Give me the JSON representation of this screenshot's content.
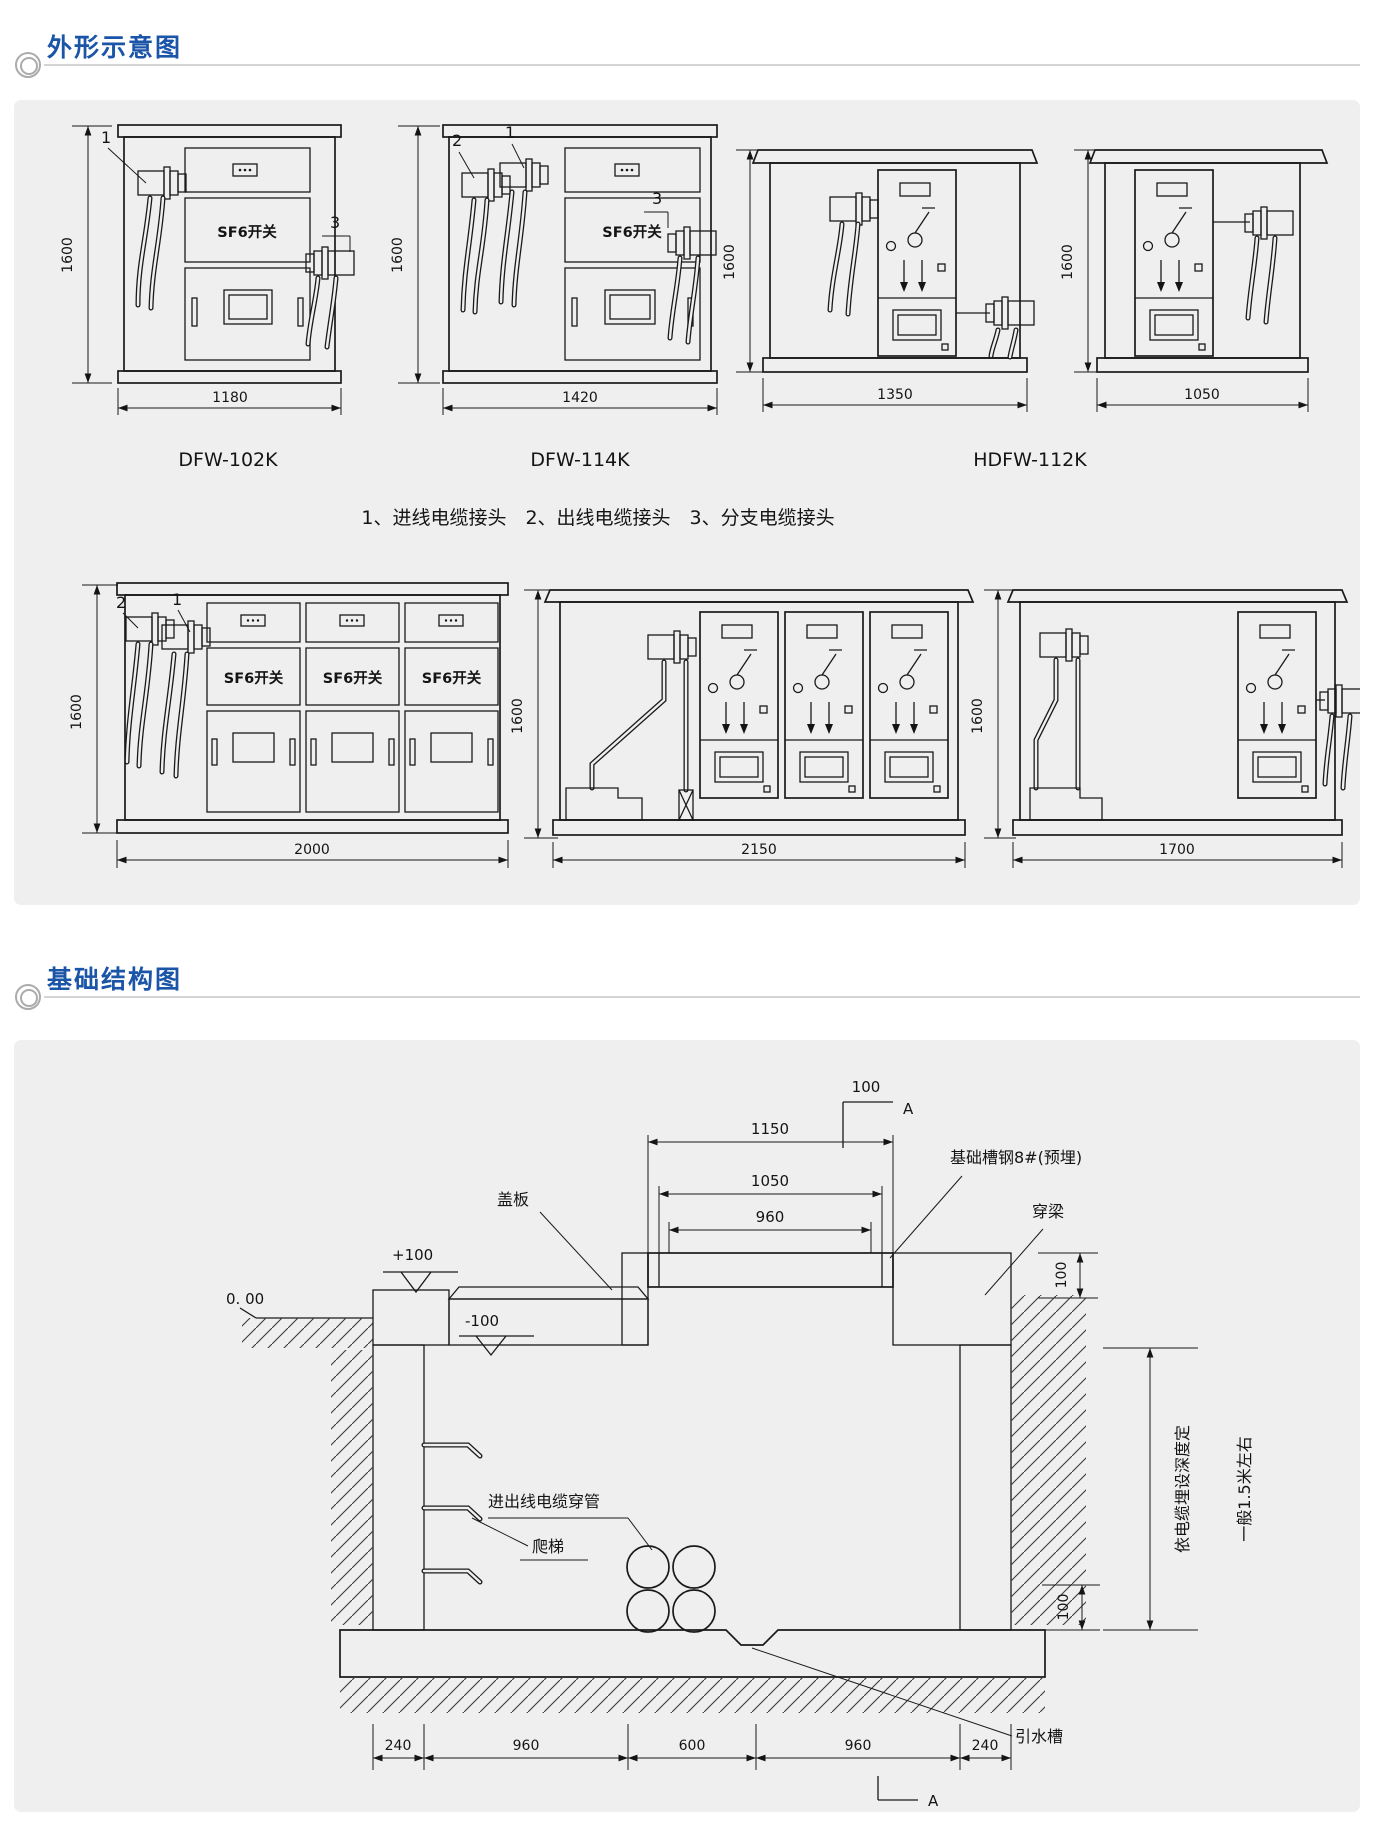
{
  "meta": {
    "accent": "#1b55a8",
    "panel_bg": "#efefef",
    "line_color": "#1a1a1a"
  },
  "sections": {
    "outline": {
      "title": "外形示意图"
    },
    "foundation": {
      "title": "基础结构图"
    }
  },
  "outline": {
    "sf6": "SF6开关",
    "legend": "1、进线电缆接头　2、出线电缆接头　3、分支电缆接头",
    "callouts": {
      "in": "1",
      "out": "2",
      "branch": "3"
    },
    "row1": [
      {
        "model": "DFW-102K",
        "h": "1600",
        "w": "1180"
      },
      {
        "model": "DFW-114K",
        "h": "1600",
        "w": "1420"
      },
      {
        "model": "HDFW-112K",
        "h": "1600",
        "w": "1350"
      },
      {
        "h": "1600",
        "w": "1050"
      }
    ],
    "row2": [
      {
        "h": "1600",
        "w": "2000"
      },
      {
        "h": "1600",
        "w": "2150"
      },
      {
        "h": "1600",
        "w": "1700"
      }
    ]
  },
  "foundation": {
    "section_dim": "100",
    "section_mark_top": "A",
    "section_mark_bottom": "A",
    "dims": {
      "d1150": "1150",
      "d1050": "1050",
      "d960": "960",
      "beam_h": "100",
      "step_h": "100",
      "bottom": [
        "240",
        "960",
        "600",
        "960",
        "240"
      ]
    },
    "levels": {
      "zero": "0. 00",
      "plus": "+100",
      "minus": "-100"
    },
    "labels": {
      "cover": "盖板",
      "steel": "基础槽钢8#(预埋)",
      "beam": "穿梁",
      "conduit": "进出线电缆穿管",
      "ladder": "爬梯",
      "drain": "引水槽",
      "depth_a": "依电缆埋设深度定",
      "depth_b": "一般1.5米左右"
    }
  }
}
